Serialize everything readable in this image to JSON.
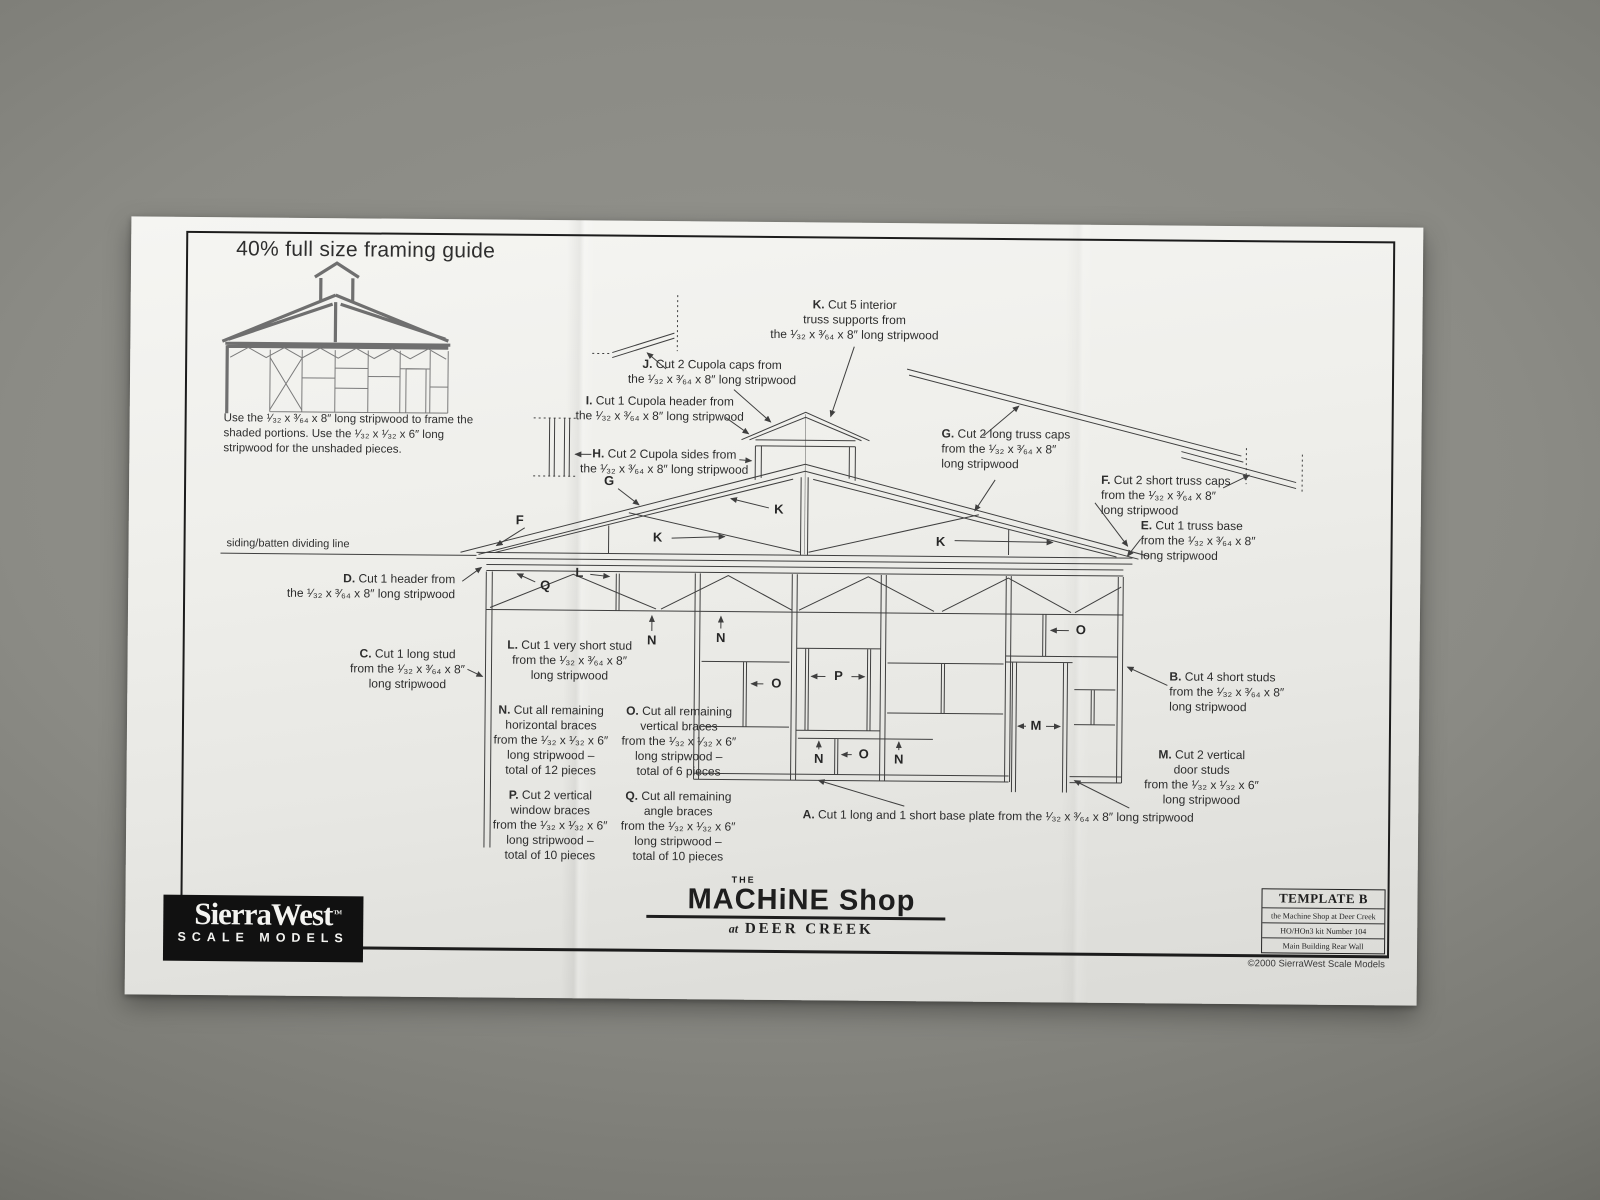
{
  "guide": {
    "title": "40% full size framing guide",
    "instructions": "Use the ¹⁄₃₂ x ³⁄₆₄ x 8″ long stripwood to frame the shaded portions. Use the ¹⁄₃₂ x ¹⁄₃₂ x 6″ long stripwood for the unshaded pieces.",
    "dividing_line_label": "siding/batten dividing line"
  },
  "callouts": [
    {
      "letter": "K",
      "x": 724,
      "y": 75,
      "align": "center",
      "lines": [
        "Cut 5 interior",
        "truss supports from",
        "the ¹⁄₃₂ x ³⁄₆₄ x 8″ long stripwood"
      ]
    },
    {
      "letter": "J",
      "x": 582,
      "y": 136,
      "align": "center",
      "lines": [
        "Cut 2 Cupola caps from",
        "the ¹⁄₃₂ x ³⁄₆₄ x 8″ long stripwood"
      ]
    },
    {
      "letter": "I",
      "x": 530,
      "y": 173,
      "align": "center",
      "lines": [
        "Cut 1 Cupola header from",
        "the ¹⁄₃₂ x ³⁄₆₄ x 8″ long stripwood"
      ]
    },
    {
      "letter": "H",
      "x": 535,
      "y": 226,
      "align": "center",
      "lines": [
        "Cut 2 Cupola sides from",
        "the ¹⁄₃₂ x ³⁄₆₄ x 8″ long stripwood"
      ]
    },
    {
      "letter": "G",
      "x": 812,
      "y": 203,
      "align": "left",
      "lines": [
        "Cut 2 long truss caps",
        "from the ¹⁄₃₂ x ³⁄₆₄ x 8″",
        "long stripwood"
      ]
    },
    {
      "letter": "F",
      "x": 972,
      "y": 248,
      "align": "left",
      "lines": [
        "Cut 2 short truss caps",
        "from the ¹⁄₃₂ x ³⁄₆₄ x 8″",
        "long stripwood"
      ]
    },
    {
      "letter": "E",
      "x": 1012,
      "y": 293,
      "align": "left",
      "lines": [
        "Cut 1 truss base",
        "from the ¹⁄₃₂ x ³⁄₆₄ x 8″",
        "long stripwood"
      ]
    },
    {
      "letter": "D",
      "x": 327,
      "y": 353,
      "align": "right",
      "lines": [
        "Cut 1 header from",
        "the ¹⁄₃₂ x ³⁄₆₄ x 8″ long stripwood"
      ]
    },
    {
      "letter": "C",
      "x": 280,
      "y": 428,
      "align": "center",
      "lines": [
        "Cut 1 long stud",
        "from the ¹⁄₃₂ x ³⁄₆₄ x 8″",
        "long stripwood"
      ]
    },
    {
      "letter": "L",
      "x": 442,
      "y": 418,
      "align": "center",
      "lines": [
        "Cut 1 very short stud",
        "from the ¹⁄₃₂ x ³⁄₆₄ x 8″",
        "long stripwood"
      ]
    },
    {
      "letter": "B",
      "x": 1042,
      "y": 444,
      "align": "left",
      "lines": [
        "Cut 4 short studs",
        "from the ¹⁄₃₂ x ³⁄₆₄ x 8″",
        "long stripwood"
      ]
    },
    {
      "letter": "N",
      "x": 424,
      "y": 483,
      "align": "center",
      "lines": [
        "Cut all remaining",
        "horizontal braces",
        "from the ¹⁄₃₂ x ¹⁄₃₂ x 6″",
        "long stripwood –",
        "total of 12 pieces"
      ]
    },
    {
      "letter": "O",
      "x": 552,
      "y": 483,
      "align": "center",
      "lines": [
        "Cut all remaining",
        "vertical braces",
        "from the ¹⁄₃₂ x ¹⁄₃₂ x 6″",
        "long stripwood –",
        "total of 6 pieces"
      ]
    },
    {
      "letter": "M",
      "x": 1075,
      "y": 522,
      "align": "center",
      "lines": [
        "Cut 2 vertical",
        "door studs",
        "from the ¹⁄₃₂ x ¹⁄₃₂ x 6″",
        "long stripwood"
      ]
    },
    {
      "letter": "P",
      "x": 424,
      "y": 568,
      "align": "center",
      "lines": [
        "Cut 2 vertical",
        "window braces",
        "from the ¹⁄₃₂ x ¹⁄₃₂ x 6″",
        "long stripwood –",
        "total of 10 pieces"
      ]
    },
    {
      "letter": "Q",
      "x": 552,
      "y": 568,
      "align": "center",
      "lines": [
        "Cut all remaining",
        "angle braces",
        "from the ¹⁄₃₂ x ¹⁄₃₂ x 6″",
        "long stripwood –",
        "total of 10 pieces"
      ]
    },
    {
      "letter": "A",
      "x": 872,
      "y": 585,
      "align": "center",
      "lines": [
        "Cut 1 long and 1 short base plate from the ¹⁄₃₂ x ³⁄₆₄ x 8″ long stripwood"
      ]
    }
  ],
  "markers": [
    {
      "t": "G",
      "x": 480,
      "y": 260
    },
    {
      "t": "F",
      "x": 391,
      "y": 300
    },
    {
      "t": "K",
      "x": 529,
      "y": 316
    },
    {
      "t": "K",
      "x": 650,
      "y": 287
    },
    {
      "t": "K",
      "x": 812,
      "y": 318
    },
    {
      "t": "Q",
      "x": 417,
      "y": 365
    },
    {
      "t": "L",
      "x": 451,
      "y": 352
    },
    {
      "t": "N",
      "x": 524,
      "y": 419
    },
    {
      "t": "N",
      "x": 593,
      "y": 416
    },
    {
      "t": "O",
      "x": 649,
      "y": 461
    },
    {
      "t": "P",
      "x": 711,
      "y": 453
    },
    {
      "t": "O",
      "x": 953,
      "y": 405
    },
    {
      "t": "N",
      "x": 692,
      "y": 536
    },
    {
      "t": "O",
      "x": 737,
      "y": 531
    },
    {
      "t": "N",
      "x": 772,
      "y": 536
    },
    {
      "t": "M",
      "x": 909,
      "y": 501
    }
  ],
  "footer": {
    "brand": {
      "name": "SierraWest",
      "tm": "TM",
      "subtitle": "SCALE MODELS"
    },
    "product": {
      "the": "THE",
      "name": "MACHiNE Shop",
      "at": "at",
      "place": "DEER CREEK"
    },
    "template_box": {
      "title": "TEMPLATE B",
      "rows": [
        "the Machine Shop at Deer Creek",
        "HO/HOn3 kit Number 104",
        "Main Building Rear Wall"
      ]
    },
    "copyright": "©2000 SierraWest Scale Models"
  }
}
